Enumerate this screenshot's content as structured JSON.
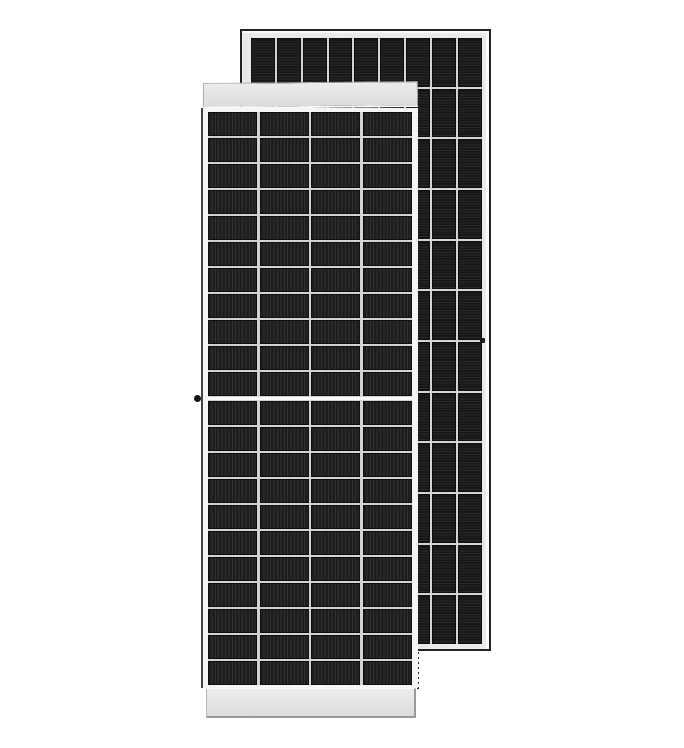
{
  "scene": {
    "description": "Product photo of two portrait-orientation monocrystalline solar panel modules on a white background; front module overlaps the taller rear module",
    "background_color": "#ffffff"
  },
  "rear_panel": {
    "label": "rear solar panel module",
    "cell_columns": 9,
    "cell_rows": 12,
    "cell_texture": "horizontal busbar stripes",
    "colors": {
      "outline": "#232323",
      "frame": "#eaeaea",
      "frame_highlight": "#fafafa",
      "grid_line": "#d5d5d5",
      "cell_dark": "#171717",
      "cell_light": "#292929",
      "cell_edge": "#0f0f0f"
    },
    "details": {
      "mounting_hole_on_right_frame": true
    }
  },
  "front_panel": {
    "label": "front solar panel module (half-cut cell layout)",
    "cell_columns": 4,
    "cell_rows_upper_half": 11,
    "cell_rows_lower_half": 11,
    "center_split": true,
    "cell_texture": "vertical busbar stripes",
    "colors": {
      "frame": "#f5f5f5",
      "left_hairline": "#434343",
      "grid_line": "#d3d3d3",
      "cell_dark": "#1d1d1d",
      "cell_light": "#313131",
      "cell_edge": "#101010",
      "split_band": "#f8f8f8",
      "split_edge": "#d2d2d2"
    },
    "frame_caps": {
      "fill_top": "#ececec",
      "fill_bottom": "#dcdcdc",
      "edge": "#a8a8a8",
      "edge_soft": "#b8b8b8",
      "edge_dark": "#9a9a9a",
      "white_line": "#fafafa"
    },
    "details": {
      "grounding_hole_dot_color": "#141414",
      "side_clip_mark_color": "#191919",
      "hidden_edge_dash_color": "#2c2c2c"
    }
  }
}
